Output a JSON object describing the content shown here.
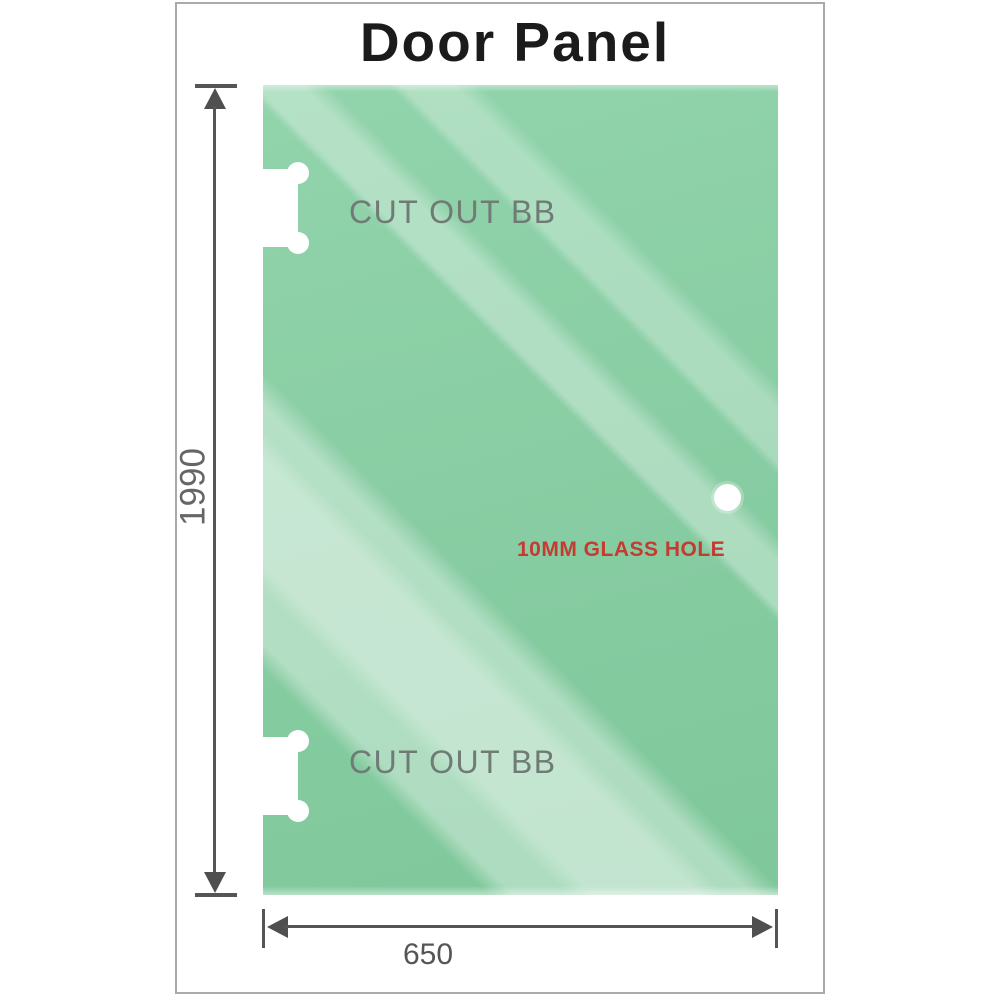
{
  "title": "Door Panel",
  "panel": {
    "cutouts": [
      {
        "label": "CUT OUT BB"
      },
      {
        "label": "CUT OUT BB"
      }
    ],
    "glass_hole_label": "10MM GLASS HOLE"
  },
  "dimensions": {
    "height": "1990",
    "width": "650"
  },
  "colors": {
    "glass_green": "#8bcfa5",
    "glass_highlight": "#c1e4cf",
    "dimension_gray": "#555555",
    "cutout_label_gray": "#6f7b74",
    "glass_hole_red": "#c43b32",
    "title_black": "#1b1b1b",
    "frame_border": "#aaaaaa"
  }
}
